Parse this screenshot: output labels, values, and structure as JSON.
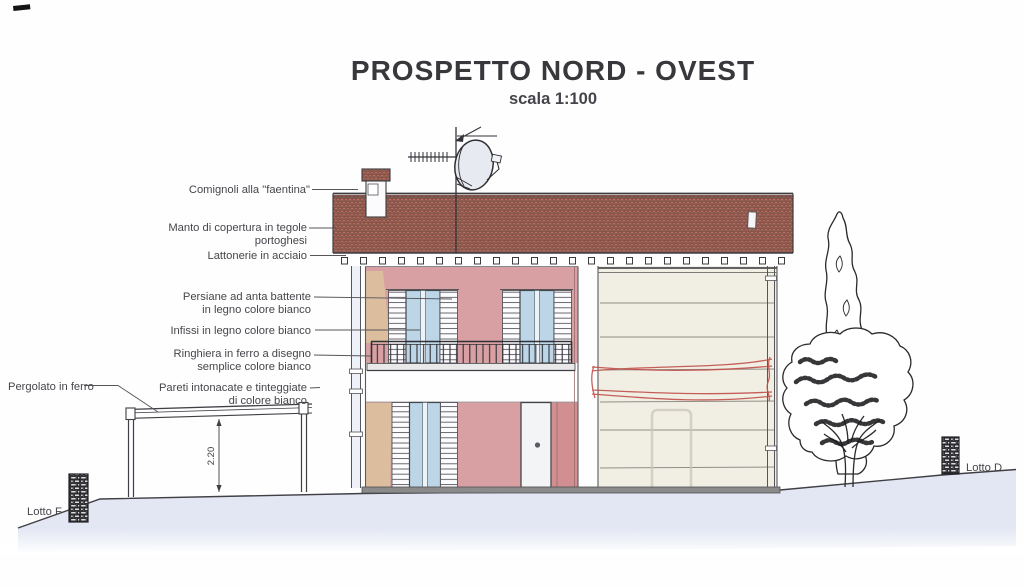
{
  "header": {
    "title": "PROSPETTO NORD - OVEST",
    "subtitle": "scala 1:100"
  },
  "annotations": {
    "comignoli": "Comignoli alla \"faentina\"",
    "manto_1": "Manto di copertura in tegole",
    "manto_2": "portoghesi",
    "lattonerie": "Lattonerie in acciaio",
    "persiane_1": "Persiane ad anta battente",
    "persiane_2": "in legno colore bianco",
    "infissi": "Infissi in legno colore bianco",
    "ringhiera_1": "Ringhiera in ferro a disegno",
    "ringhiera_2": "semplice colore bianco",
    "pareti_1": "Pareti intonacate e tinteggiate",
    "pareti_2": "di colore bianco",
    "pergolato": "Pergolato in ferro"
  },
  "lots": {
    "left": "Lotto F",
    "right": "Lotto D"
  },
  "dimensions": {
    "pergola_height": "2.20"
  },
  "colors": {
    "line": "#3f3f45",
    "wall_pink": "#d8a0a2",
    "wall_pink_deep": "#d18f92",
    "wall_tan": "#dcc09e",
    "glass": "#bcd6e8",
    "door_white": "#f3f4f6",
    "wall_cream": "#f1efe4",
    "ground": "#e3e7f3",
    "roof_tile": "#c18a7d",
    "red_mark": "#c14f4a"
  }
}
